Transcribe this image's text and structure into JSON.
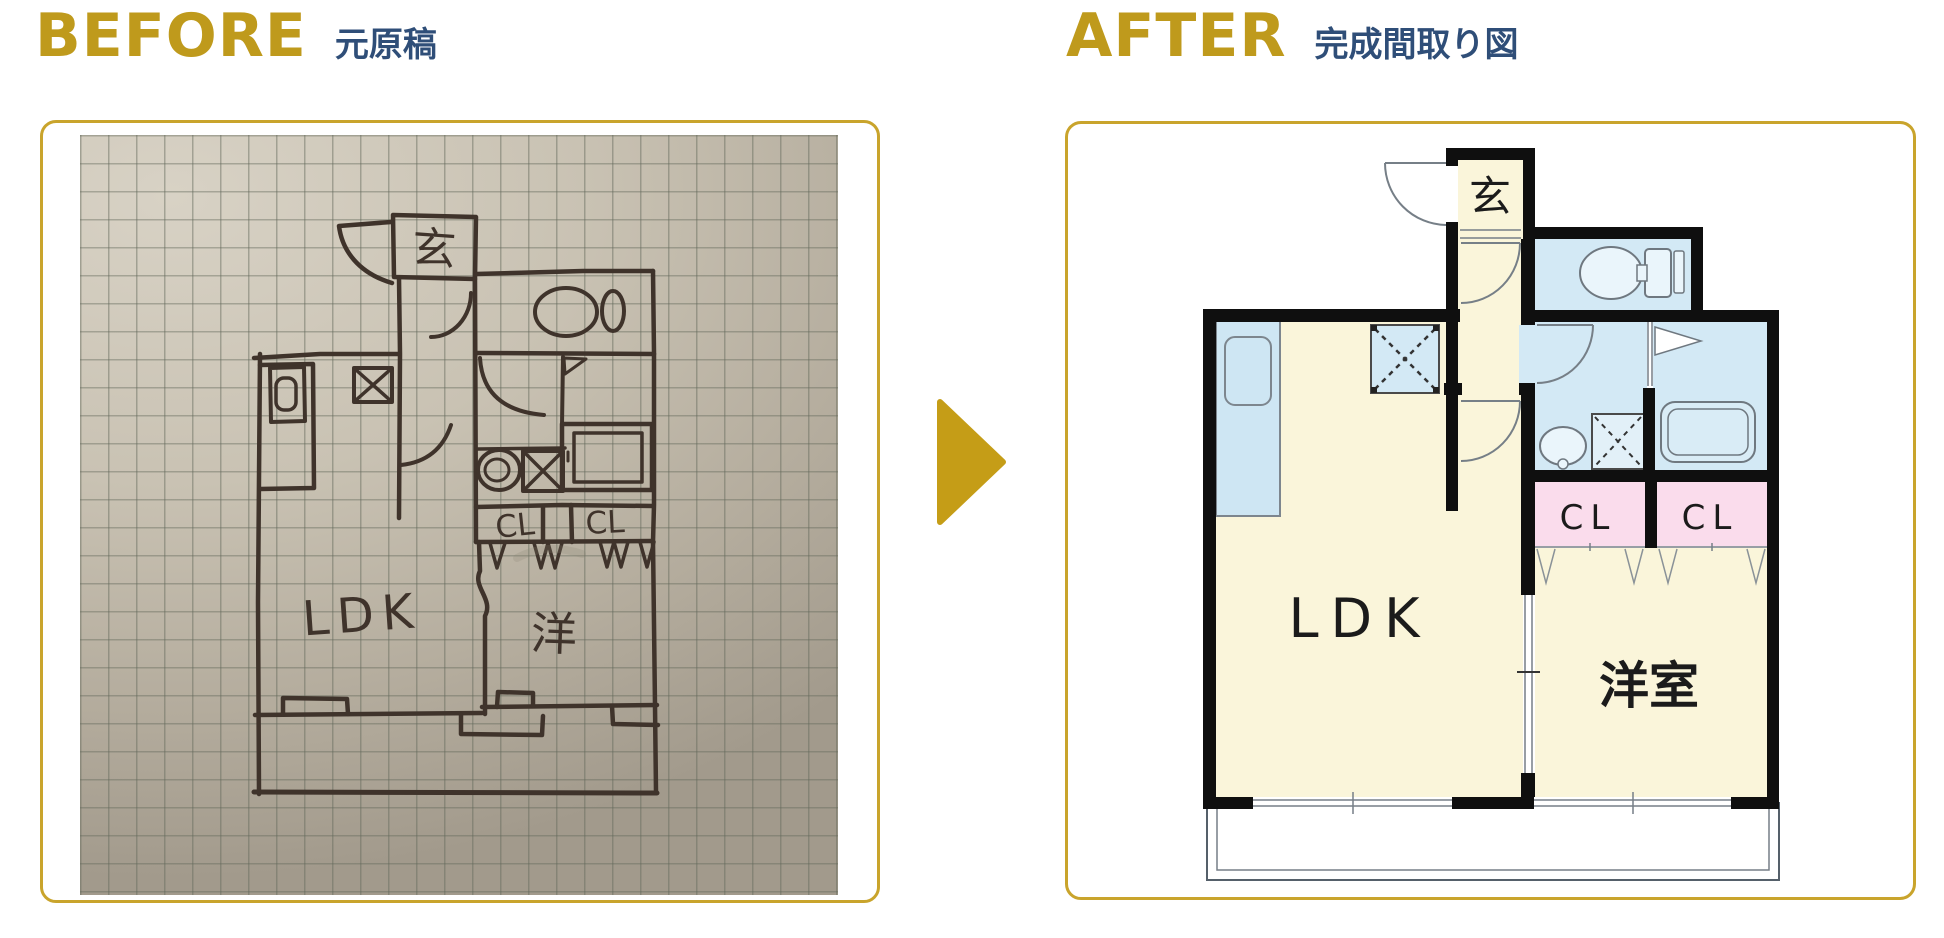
{
  "headers": {
    "before": {
      "title": "BEFORE",
      "subtitle": "元原稿"
    },
    "after": {
      "title": "AFTER",
      "subtitle": "完成間取り図"
    }
  },
  "arrow_icon": "right-triangle",
  "colors": {
    "accent_gold": "#bf9a1c",
    "heading_navy": "#2f4e78",
    "panel_border": "#c9a42c",
    "arrow_gold": "#c59d17",
    "plan_wall": "#0f0f0f",
    "room_cream": "#faf5da",
    "room_blue": "#d3e9f5",
    "room_pink": "#fadcec",
    "sketch_ink": "#3f332b",
    "photo_paper": "#c2baab"
  },
  "before_plan": {
    "labels": {
      "entrance": "玄",
      "closet_left": "CL",
      "closet_right": "CL",
      "ldk": "LDK",
      "western_room": "洋"
    }
  },
  "after_plan": {
    "labels": {
      "entrance": "玄",
      "closet_left": "CL",
      "closet_right": "CL",
      "ldk": "LDK",
      "western_room": "洋室"
    }
  }
}
